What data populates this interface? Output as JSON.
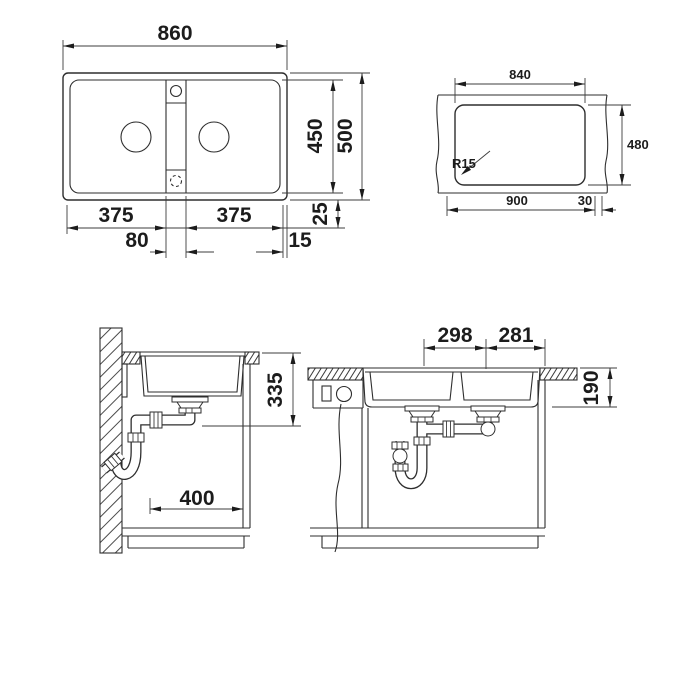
{
  "colors": {
    "line": "#2e2e2e",
    "dimension_line": "#3c3c3c",
    "text": "#1c1c1c",
    "background": "#ffffff"
  },
  "views": {
    "top_view": {
      "overall_width": "860",
      "bowl_length": "450",
      "overall_length": "500",
      "left_bowl_width": "375",
      "right_bowl_width": "375",
      "center_web_width": "80",
      "edge_margin": "15",
      "rim_margin": "25"
    },
    "cutout_view": {
      "cutout_width": "840",
      "cutout_height": "480",
      "corner_radius": "R15",
      "min_cabinet_width": "900",
      "edge_distance": "30"
    },
    "side_section": {
      "drain_height": "335",
      "rear_clearance": "400"
    },
    "front_section": {
      "left_bowl_span": "298",
      "right_bowl_span": "281",
      "bowl_depth": "190"
    }
  }
}
